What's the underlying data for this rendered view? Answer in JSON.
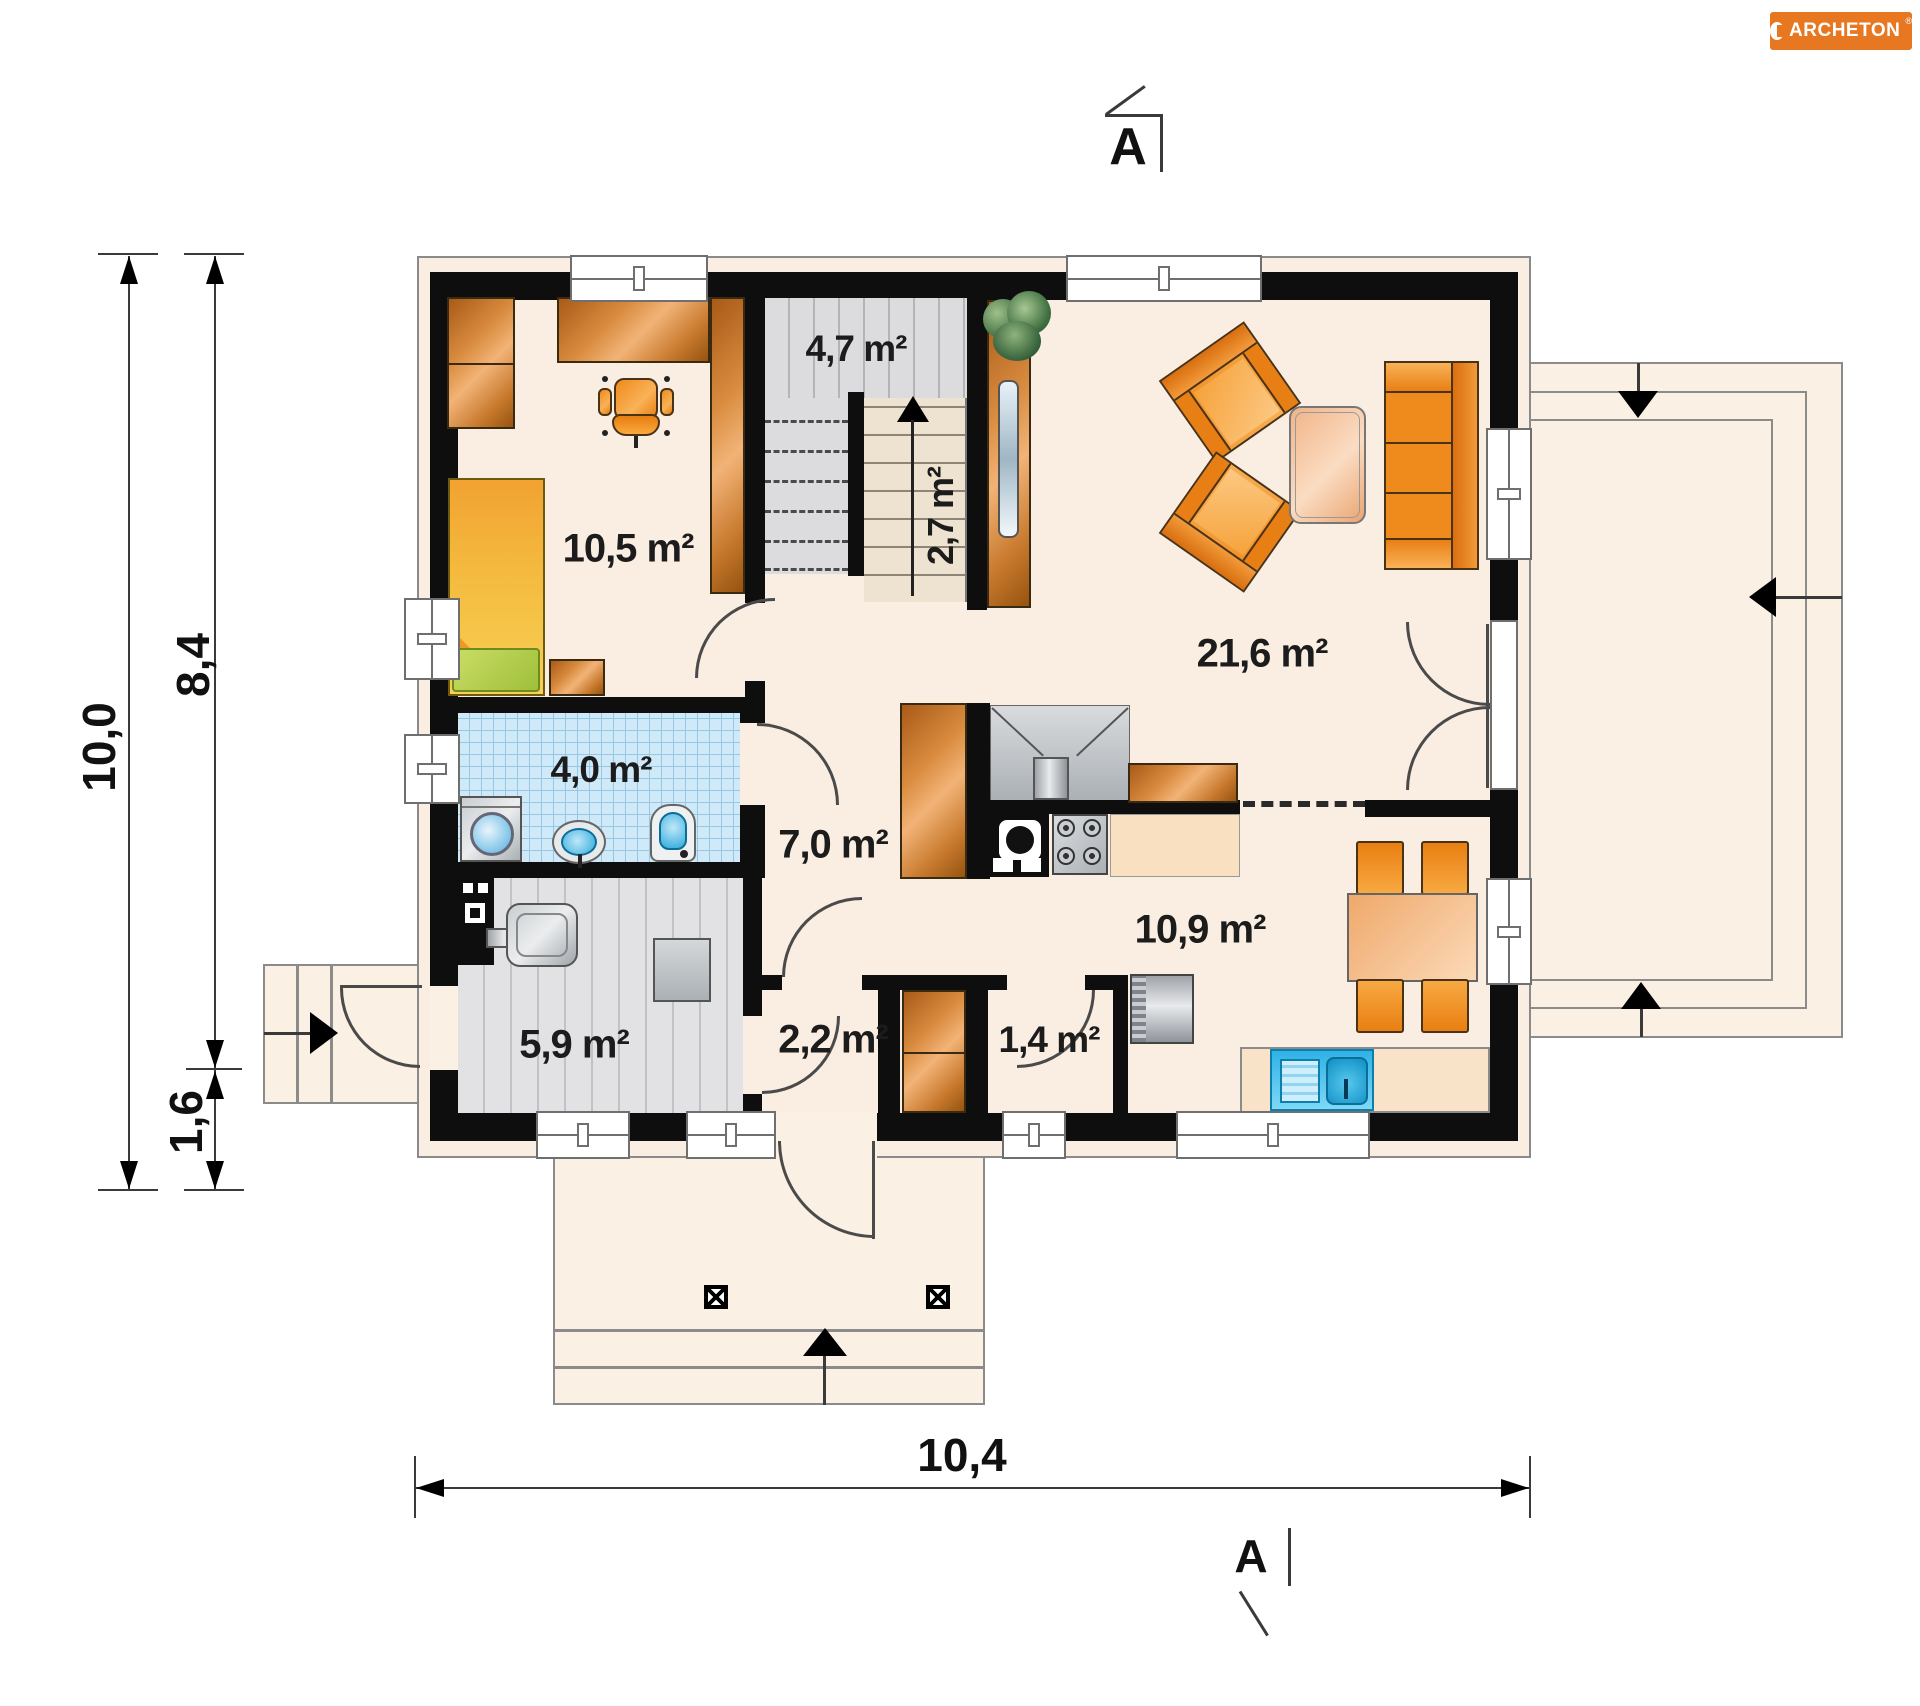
{
  "brand": {
    "name": "ARCHETON",
    "registered": "®",
    "bg_color": "#E87722"
  },
  "section_markers": {
    "top": "A",
    "bottom": "A"
  },
  "dimensions": {
    "total_depth": "10,0",
    "house_depth": "8,4",
    "porch_depth": "1,6",
    "total_width": "10,4"
  },
  "rooms": [
    {
      "name": "bedroom",
      "label": "10,5 m²"
    },
    {
      "name": "staircase-upper",
      "label": "4,7 m²"
    },
    {
      "name": "staircase-lower",
      "label": "2,7 m²"
    },
    {
      "name": "living-room",
      "label": "21,6 m²"
    },
    {
      "name": "bathroom",
      "label": "4,0 m²"
    },
    {
      "name": "hall",
      "label": "7,0 m²"
    },
    {
      "name": "kitchen",
      "label": "10,9 m²"
    },
    {
      "name": "boiler-room",
      "label": "5,9 m²"
    },
    {
      "name": "wc",
      "label": "2,2 m²"
    },
    {
      "name": "pantry",
      "label": "1,4 m²"
    }
  ],
  "colors": {
    "wall": "#0E0E0E",
    "floor_cream": "#F9EEE1",
    "terrace_cream": "#FAF0E3",
    "furniture_orange": "#EE8A1F",
    "wood_brown": "#C87A36",
    "tile_blue": "#CFE9F8",
    "boiler_gray": "#E2E2E4",
    "stair_beige": "#EEE3D1",
    "brand_orange": "#E87722"
  }
}
